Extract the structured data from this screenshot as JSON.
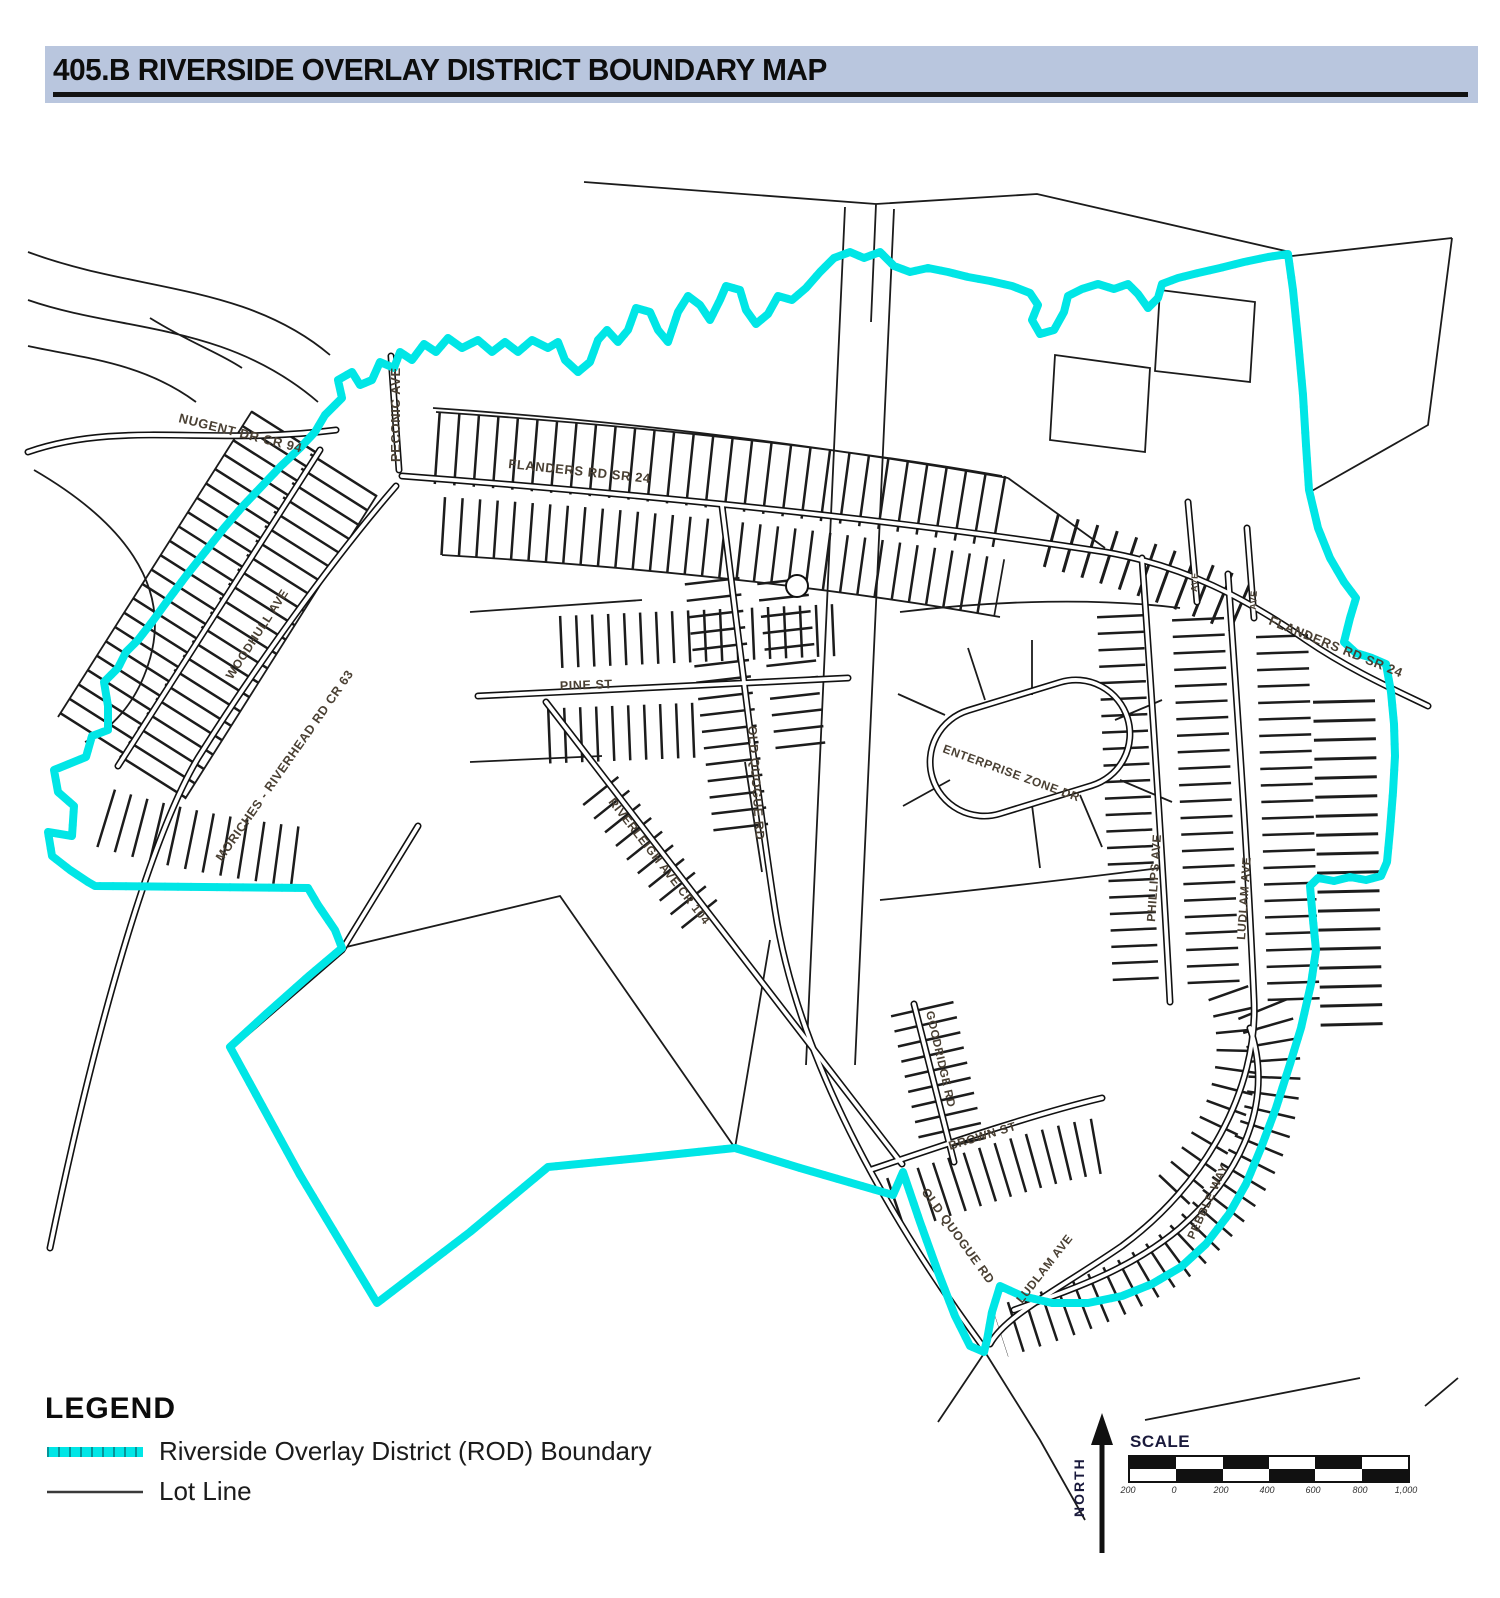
{
  "title": "405.B RIVERSIDE OVERLAY DISTRICT BOUNDARY MAP",
  "colors": {
    "header_bg": "#b9c6de",
    "rod_boundary": "#00e6e6",
    "lot_line": "#1b1b1b",
    "street_label": "#4a4033"
  },
  "map": {
    "street_labels": {
      "nugent": "NUGENT DR CR 94",
      "peconic": "PECONIC AVE",
      "flanders_w": "FLANDERS RD SR 24",
      "flanders_e": "FLANDERS RD SR 24",
      "woodhull": "WOODHULL AVE",
      "moriches": "MORICHES - RIVERHEAD RD CR 63",
      "pine": "PINE ST",
      "old_quogue_n": "OLD QUOGUE RD",
      "old_quogue_s": "OLD QUOGUE RD",
      "riverleigh": "RIVERLEIGH AVE CR 104",
      "enterprise": "ENTERPRISE ZONE DR",
      "phillips": "PHILLIPS AVE",
      "ludlam_n": "LUDLAM AVE",
      "ludlam_s": "LUDLAM AVE",
      "goodridge": "GOODRIDGE RD",
      "brown": "BROWN ST",
      "pebble": "PEBBLE WAY",
      "small_ne_1": "AVE",
      "small_ne_2": "AVE"
    }
  },
  "legend": {
    "heading": "LEGEND",
    "items": [
      {
        "label": "Riverside Overlay District (ROD) Boundary"
      },
      {
        "label": "Lot Line"
      }
    ]
  },
  "compass": {
    "label": "NORTH"
  },
  "scale": {
    "label": "SCALE",
    "ticks": [
      "200",
      "0",
      "200",
      "400",
      "600",
      "800",
      "1,000"
    ]
  }
}
